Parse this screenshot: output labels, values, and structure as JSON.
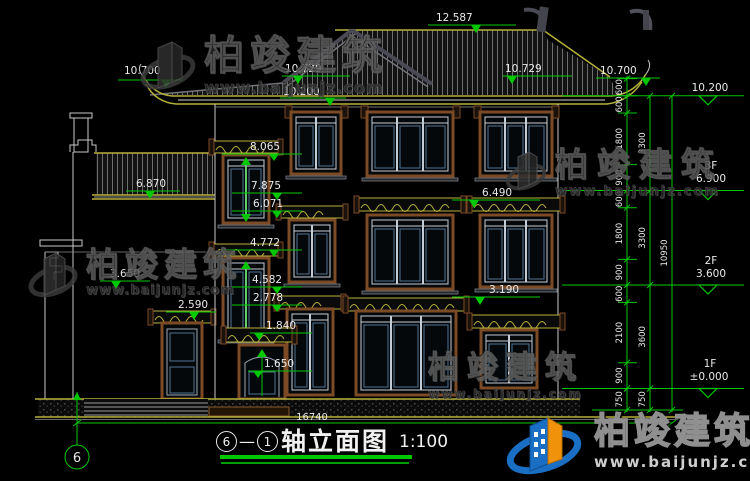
{
  "watermark": {
    "brand": "柏竣建筑",
    "url": "www.baijunjz.com"
  },
  "title": {
    "axis_start": "6",
    "dash": "—",
    "axis_end": "1",
    "name": "轴立面图",
    "scale": "1:100"
  },
  "axis_bubble": {
    "label": "6"
  },
  "levels": {
    "ridge": "12.587",
    "eave_left": "10.700",
    "eave_left_inner": "10.729",
    "fascia_left": "10.200",
    "eave_right_inner": "10.729",
    "eave_right": "10.700",
    "fascia_right": "10.200",
    "left_roof": "6.870",
    "left_cornice": "3.650",
    "left_door_head": "2.590",
    "stair_lintel_top": "8.065",
    "stair_window_top": "7.875",
    "stair_window_sill": "6.071",
    "stair2_lintel_top": "4.772",
    "stair2_window_top": "4.582",
    "stair2_window_sill": "2.778",
    "balcony_3f": "6.490",
    "balcony_2f": "3.190",
    "porch_head": "1.840",
    "porch_sill": "1.650",
    "floor3_tag": "3F",
    "floor3": "6.900",
    "floor2_tag": "2F",
    "floor2": "3.600",
    "floor1_tag": "1F",
    "floor1": "±0.000"
  },
  "dims": {
    "total_width": "16740",
    "total_height": "10950",
    "chain_segments": [
      "600",
      "600",
      "1800",
      "900",
      "600",
      "1800",
      "900",
      "600",
      "2100",
      "900",
      "750"
    ],
    "chain_floors": [
      "3300",
      "3300",
      "3600",
      "750"
    ]
  },
  "colors": {
    "background": "#000000",
    "dimension_green": "#00c800",
    "line_olive": "#b7b13a",
    "text_white": "#e9e9e9",
    "frame_brown": "#7d4a26",
    "mullion_blue": "#5f7f9f",
    "logo_blue": "#1a6fc4",
    "logo_orange": "#f0930a"
  }
}
